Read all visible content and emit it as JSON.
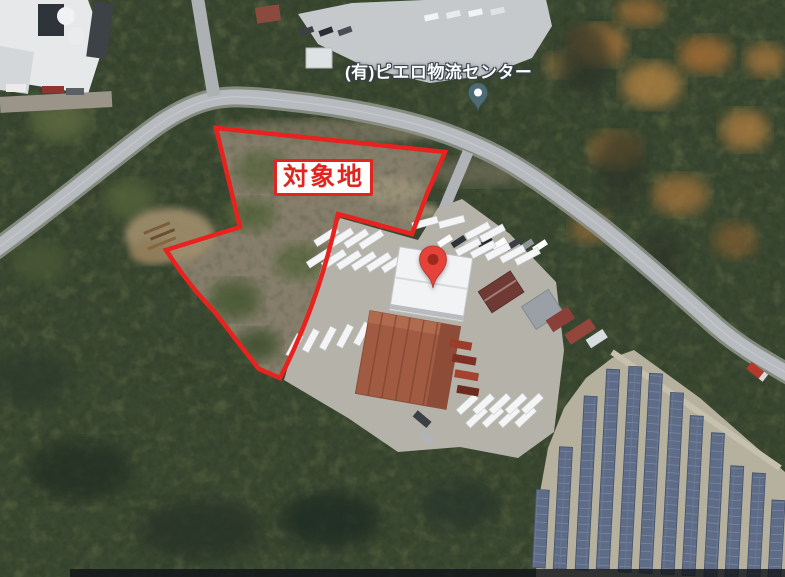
{
  "map": {
    "view": "satellite-aerial",
    "annotation": {
      "target_site_label": "対象地"
    },
    "place": {
      "name": "(有)ピエロ物流センター"
    },
    "markers": {
      "red_marker_name": "red-map-pin",
      "place_pin_name": "place-pin"
    },
    "colors": {
      "boundary": "#e8221e",
      "annotation_red": "#e2241f",
      "red_pin": "#e5433a",
      "red_pin_dot": "#9e2a1e",
      "place_pin": "#4d6b74",
      "road": "#b7bbbf",
      "forest": "#3a4731",
      "scrub": "#867e6b",
      "solar_panel": "#5e6c87",
      "solar_ground": "#b6b09e"
    }
  }
}
